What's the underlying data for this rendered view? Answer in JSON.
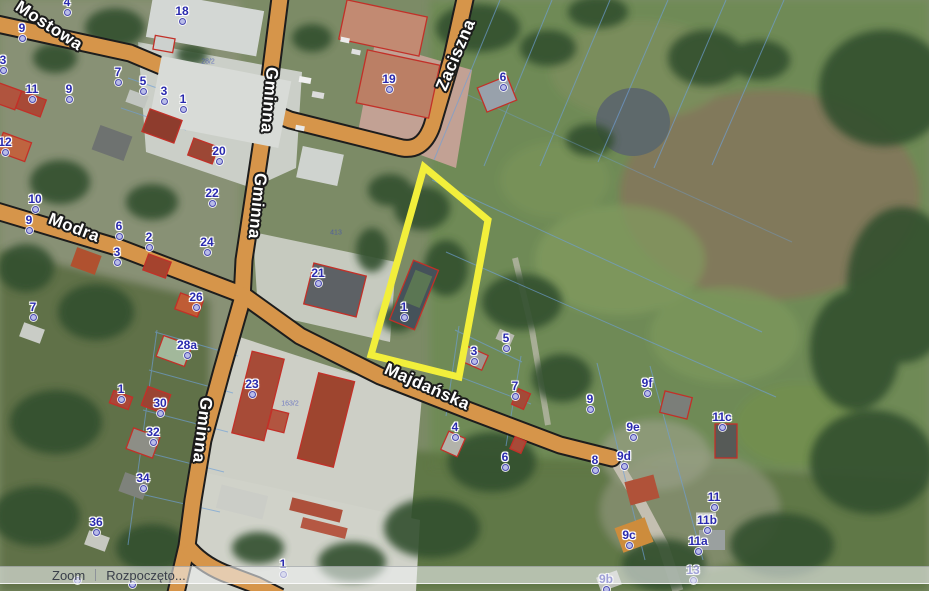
{
  "status_bar": {
    "mode_label": "Zoom",
    "message": "Rozpoczęto..."
  },
  "map": {
    "highlight_color": "#f2ef3b",
    "road_color": "#d6954a",
    "marker_color": "#2a2aae",
    "parcel_line_color": "#6fa0d8",
    "building_outline_color": "#c23028",
    "street_labels": [
      {
        "name": "Mostowa",
        "x": 49,
        "y": 26,
        "angle": 33
      },
      {
        "name": "Gminna",
        "x": 269,
        "y": 100,
        "angle": 95
      },
      {
        "name": "Gminna",
        "x": 257,
        "y": 206,
        "angle": 96
      },
      {
        "name": "Gminna",
        "x": 202,
        "y": 430,
        "angle": 97
      },
      {
        "name": "Modra",
        "x": 74,
        "y": 228,
        "angle": 21
      },
      {
        "name": "Zaciszna",
        "x": 456,
        "y": 55,
        "angle": -67
      },
      {
        "name": "Majdańska",
        "x": 427,
        "y": 387,
        "angle": 24
      }
    ],
    "parcel_labels": [
      {
        "text": "28/2",
        "x": 208,
        "y": 62
      },
      {
        "text": "413",
        "x": 336,
        "y": 233
      },
      {
        "text": "163/2",
        "x": 290,
        "y": 404
      }
    ],
    "address_markers": [
      {
        "label": "4",
        "x": 67,
        "y": 12
      },
      {
        "label": "18",
        "x": 182,
        "y": 21
      },
      {
        "label": "9",
        "x": 22,
        "y": 38
      },
      {
        "label": "7",
        "x": 118,
        "y": 82
      },
      {
        "label": "5",
        "x": 143,
        "y": 91
      },
      {
        "label": "3",
        "x": 164,
        "y": 101
      },
      {
        "label": "1",
        "x": 183,
        "y": 109
      },
      {
        "label": "3",
        "x": 3,
        "y": 70
      },
      {
        "label": "11",
        "x": 32,
        "y": 99
      },
      {
        "label": "9",
        "x": 69,
        "y": 99
      },
      {
        "label": "12",
        "x": 5,
        "y": 152
      },
      {
        "label": "10",
        "x": 35,
        "y": 209
      },
      {
        "label": "9",
        "x": 29,
        "y": 230
      },
      {
        "label": "6",
        "x": 119,
        "y": 236
      },
      {
        "label": "2",
        "x": 149,
        "y": 247
      },
      {
        "label": "3",
        "x": 117,
        "y": 262
      },
      {
        "label": "24",
        "x": 207,
        "y": 252
      },
      {
        "label": "20",
        "x": 219,
        "y": 161
      },
      {
        "label": "22",
        "x": 212,
        "y": 203
      },
      {
        "label": "26",
        "x": 196,
        "y": 307
      },
      {
        "label": "21",
        "x": 318,
        "y": 283
      },
      {
        "label": "28a",
        "x": 187,
        "y": 355
      },
      {
        "label": "23",
        "x": 252,
        "y": 394
      },
      {
        "label": "1",
        "x": 121,
        "y": 399
      },
      {
        "label": "30",
        "x": 160,
        "y": 413
      },
      {
        "label": "32",
        "x": 153,
        "y": 442
      },
      {
        "label": "34",
        "x": 143,
        "y": 488
      },
      {
        "label": "36",
        "x": 96,
        "y": 532
      },
      {
        "label": "7",
        "x": 33,
        "y": 317
      },
      {
        "label": "19",
        "x": 389,
        "y": 89
      },
      {
        "label": "6",
        "x": 503,
        "y": 87
      },
      {
        "label": "1",
        "x": 404,
        "y": 317
      },
      {
        "label": "3",
        "x": 474,
        "y": 361
      },
      {
        "label": "5",
        "x": 506,
        "y": 348
      },
      {
        "label": "7",
        "x": 515,
        "y": 396
      },
      {
        "label": "9",
        "x": 590,
        "y": 409
      },
      {
        "label": "9f",
        "x": 647,
        "y": 393
      },
      {
        "label": "9e",
        "x": 633,
        "y": 437
      },
      {
        "label": "11c",
        "x": 722,
        "y": 427
      },
      {
        "label": "8",
        "x": 595,
        "y": 470
      },
      {
        "label": "9d",
        "x": 624,
        "y": 466
      },
      {
        "label": "4",
        "x": 455,
        "y": 437
      },
      {
        "label": "6",
        "x": 505,
        "y": 467
      },
      {
        "label": "11",
        "x": 714,
        "y": 507
      },
      {
        "label": "11b",
        "x": 707,
        "y": 530
      },
      {
        "label": "9c",
        "x": 629,
        "y": 545
      },
      {
        "label": "11a",
        "x": 698,
        "y": 551
      },
      {
        "label": "13",
        "x": 693,
        "y": 580
      },
      {
        "label": "9b",
        "x": 606,
        "y": 589
      },
      {
        "label": "1",
        "x": 283,
        "y": 574
      },
      {
        "label": "",
        "x": 77,
        "y": 580
      },
      {
        "label": "",
        "x": 132,
        "y": 584
      }
    ]
  }
}
